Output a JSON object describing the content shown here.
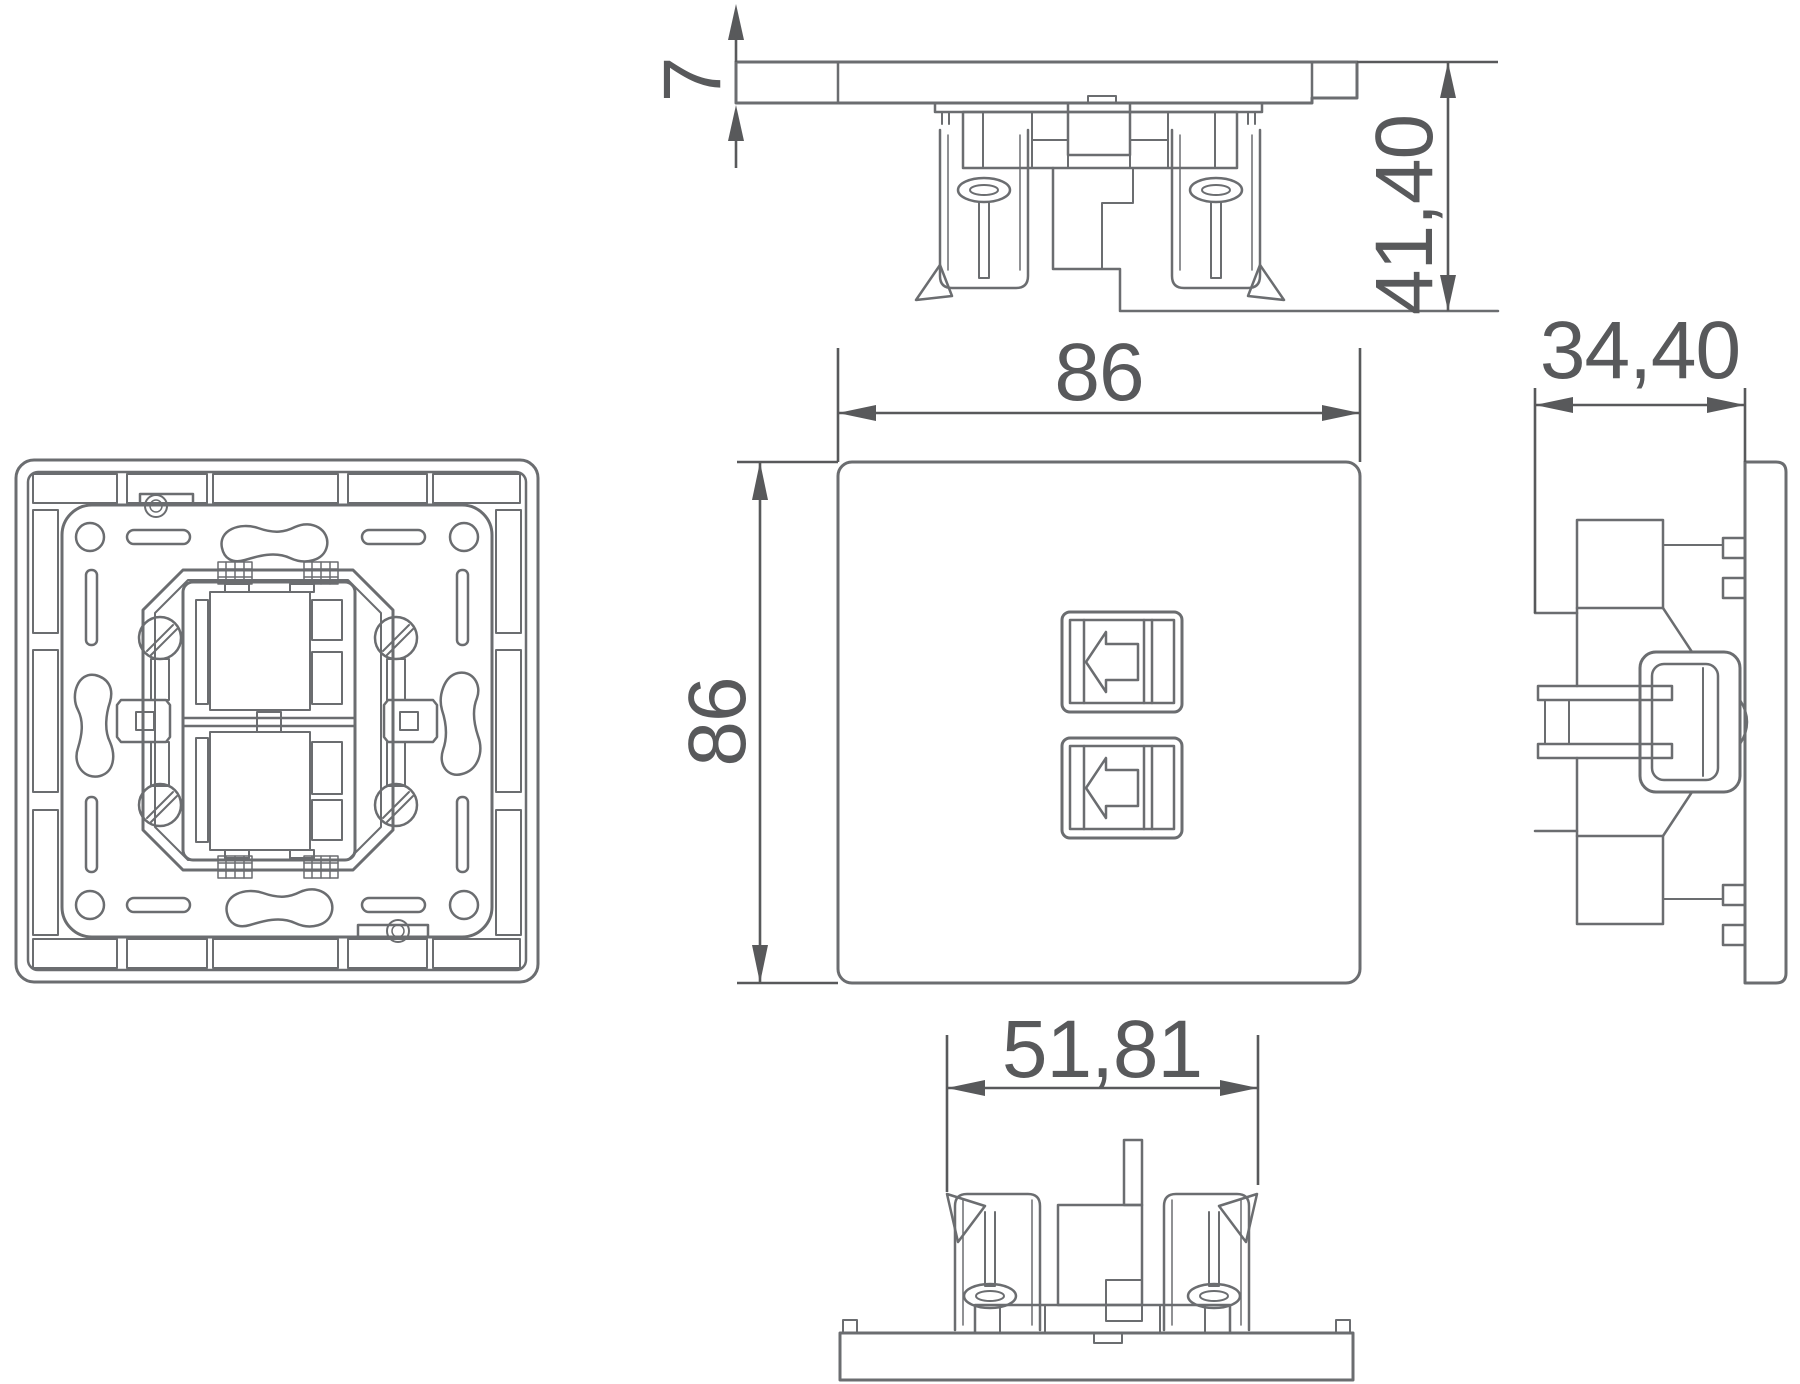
{
  "drawing": {
    "line_color": "#6b6d70",
    "dim_color": "#58595b",
    "background_color": "#ffffff",
    "icons": {
      "button_glyph": "left-arrow-outline-icon"
    },
    "dimensions": {
      "plate_thickness": "7",
      "mount_depth": "41,40",
      "plate_width": "86",
      "plate_height": "86",
      "total_depth": "34,40",
      "claw_span": "51,81"
    }
  }
}
